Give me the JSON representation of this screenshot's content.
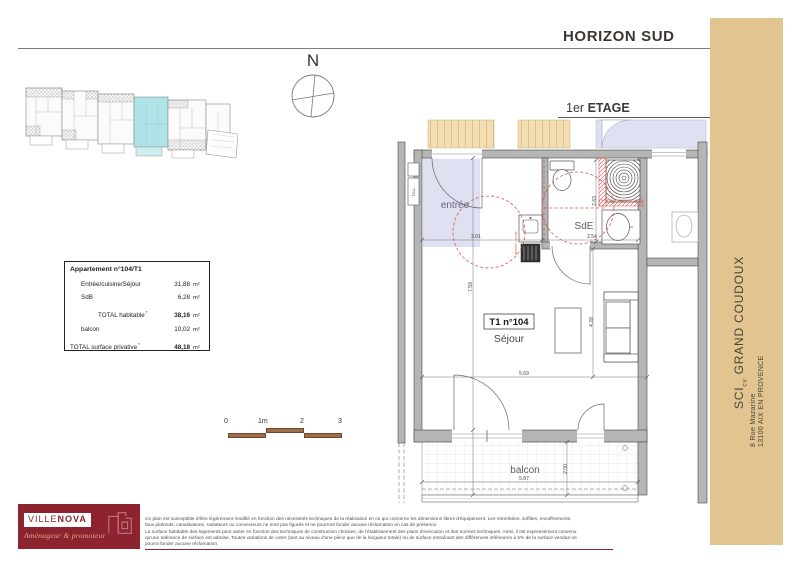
{
  "header": {
    "project": "HORIZON SUD",
    "floor": "1er",
    "floor_bold": "ETAGE",
    "doc_type": "plan de vente"
  },
  "compass": {
    "label": "N"
  },
  "sidebar": {
    "company_prefix": "SCI",
    "company_sub": "cv",
    "company_name": " GRAND COUDOUX",
    "address1": "8 Rue Mazarine",
    "address2": "13100 AIX EN PROVENCE"
  },
  "unit_table": {
    "title": "Appartement n°104/T1",
    "rows": [
      {
        "label": "Entrée/cuisine/Séjour",
        "value": "31,88",
        "unit": "m²"
      },
      {
        "label": "SdB",
        "value": "6,28",
        "unit": "m²"
      },
      {
        "label": "TOTAL habitable",
        "mark": "*",
        "value": "38,16",
        "unit": "m²"
      },
      {
        "label": "balcon",
        "value": "10,02",
        "unit": "m²"
      },
      {
        "label": "TOTAL surface privative",
        "mark": "*",
        "value": "48,18",
        "unit": "m²"
      }
    ]
  },
  "scale_bar": {
    "labels": [
      "0",
      "1m",
      "2",
      "3"
    ]
  },
  "plan": {
    "unit_id": "T1 n°104",
    "rooms": {
      "entree": "entrée",
      "sde": "SdE",
      "sejour": "Séjour",
      "balcon": "balcon"
    },
    "annotations": {
      "tgl": "T.G.L.",
      "kitchen": "attente cuisine"
    },
    "dimensions": {
      "entree_w": "3.01",
      "sde_w": "2.54",
      "sde_d": "2.63",
      "depth": "7.59",
      "sejour_h": "4.28",
      "sejour_w": "5.69",
      "balcon_w": "5.87",
      "balcon_d": "2.00"
    }
  },
  "logo": {
    "brand_light": "VILLE",
    "brand_bold": "NOVA",
    "tagline": "Aménageur & promoteur"
  },
  "disclaimer": {
    "lines": [
      "Ce plan est susceptible d'être légèrement modifié en fonction des nécessités techniques de la réalisation en ce qui concerne les dimensions libres d'équipement. Les retombées, soffites, encoffrements,",
      "faux plafonds, canalisations, radiateurs ou convecteurs ne sont pas figurés et ne pourront fonder aucune réclamation en cas de présence.",
      "La surface habitable des logements peut varier en fonction des techniques de construction choisies, de l'établissement des plans d'exécution et des normes techniques. Ainsi, il est expressément convenu",
      "qu'une tolérance de surface est admise. Toutes variations de cotes (tant au niveau d'une pièce que de la longueur totale) ou de surface entraînant des différences inférieures à 5% de la surface vendue ne",
      "pourra fonder aucune réclamation."
    ]
  },
  "colors": {
    "sidebar_tan": "#e1c48f",
    "corridor_tan": "#f3ddb2",
    "zone_lavender": "#dfe0f2",
    "wall_grey": "#b5b5b5",
    "accessibility_red": "#e0544a",
    "highlight_cyan": "#aee3e8",
    "brand_red": "#8e2330",
    "scale_brown": "#9d6c4a"
  }
}
